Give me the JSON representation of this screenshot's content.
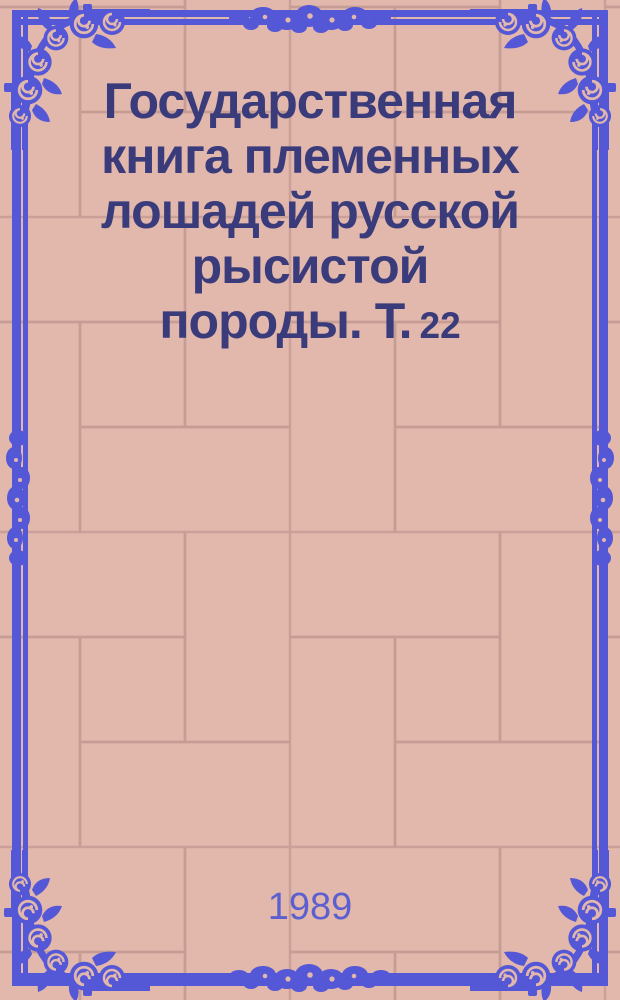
{
  "cover": {
    "title": {
      "lines": [
        "Государственная",
        "книга племенных",
        "лошадей русской",
        "рысистой"
      ],
      "last_line": "породы. Т.",
      "volume": "22"
    },
    "year": "1989",
    "colors": {
      "background": "#e2b7ac",
      "tile_line": "#c69c94",
      "ornament_blue": "#5457d6",
      "title_navy": "#3a3b7b",
      "year_blue": "#5c5fd0"
    }
  }
}
